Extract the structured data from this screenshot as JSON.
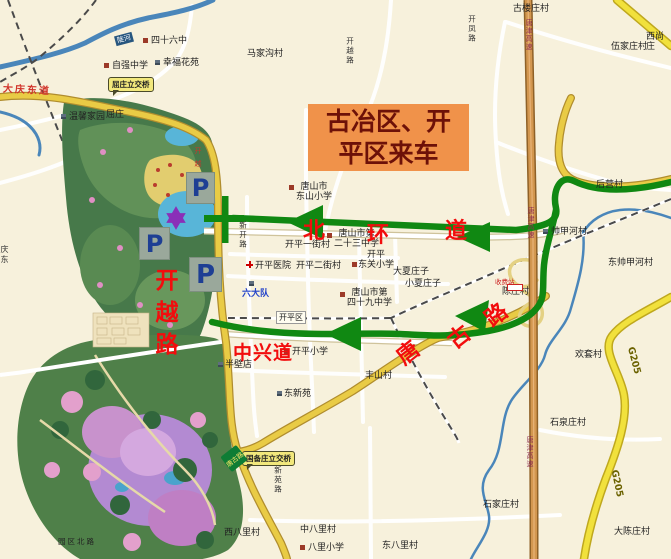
{
  "banner": {
    "line1": "古冶区、开",
    "line2": "平区来车"
  },
  "annotations": {
    "bei": "北",
    "huan": "环",
    "dao": "道",
    "tang": "唐",
    "gu": "古",
    "lu": "路",
    "kaiyuelu": "开越路",
    "kaiyuelu_small": "开越路",
    "zhongxingdao": "中兴道",
    "daqingdongdao": "大庆东道"
  },
  "markers": {
    "parking": "P"
  },
  "callouts": {
    "quzhuang": "屈庄立交桥",
    "guobeizhuang": "国备庄立交桥",
    "tanggulu_shield": "唐古路",
    "river": "陡河",
    "toll": "收费站"
  },
  "labels": [
    "四十六中",
    "幸福花苑",
    "自强中学",
    "马家沟村",
    "温馨家园",
    "屈庄",
    "古楼庄村",
    "伍家庄村",
    "西尚庄",
    "开凤路",
    "唐津高速",
    "后营村",
    "帅甲河村",
    "东帅甲河村",
    "唐津高速",
    "陈庄村",
    "欢套村",
    "石泉庄村",
    "石家庄村",
    "大陈庄村",
    "G205",
    "G205",
    "唐津高速",
    "西八里村",
    "中八里村",
    "八里小学",
    "东八里村",
    "新苑路",
    "六大队",
    "开平区",
    "唐山市\n东山小学",
    "开平一街村",
    "唐山市第\n二十三中学",
    "开平医院",
    "开平二街村",
    "开平\n东关小学",
    "大夏庄子",
    "小夏庄子",
    "唐山市第\n四十九中学",
    "开平小学",
    "半壁店",
    "东新苑",
    "丰山村",
    "园区北路",
    "开越路",
    "新开路",
    "庆东"
  ]
}
